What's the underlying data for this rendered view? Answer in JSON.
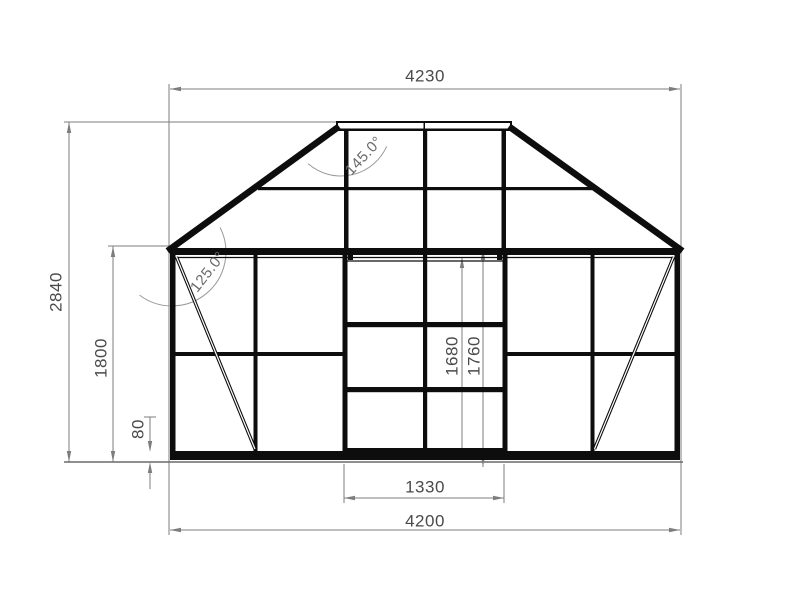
{
  "dims": {
    "top_width": "4230",
    "overall_height": "2840",
    "eave_height": "1800",
    "plinth_height": "80",
    "door_opening_height": "1680",
    "door_height": "1760",
    "door_width": "1330",
    "base_width": "4200"
  },
  "angles": {
    "ridge_angle": "145.0°",
    "eave_angle": "125.0°"
  },
  "colors": {
    "structure": "#0d0d0d",
    "dimension_lines": "#7d7d7d",
    "label_text": "#4a4a4a",
    "background": "#ffffff"
  }
}
